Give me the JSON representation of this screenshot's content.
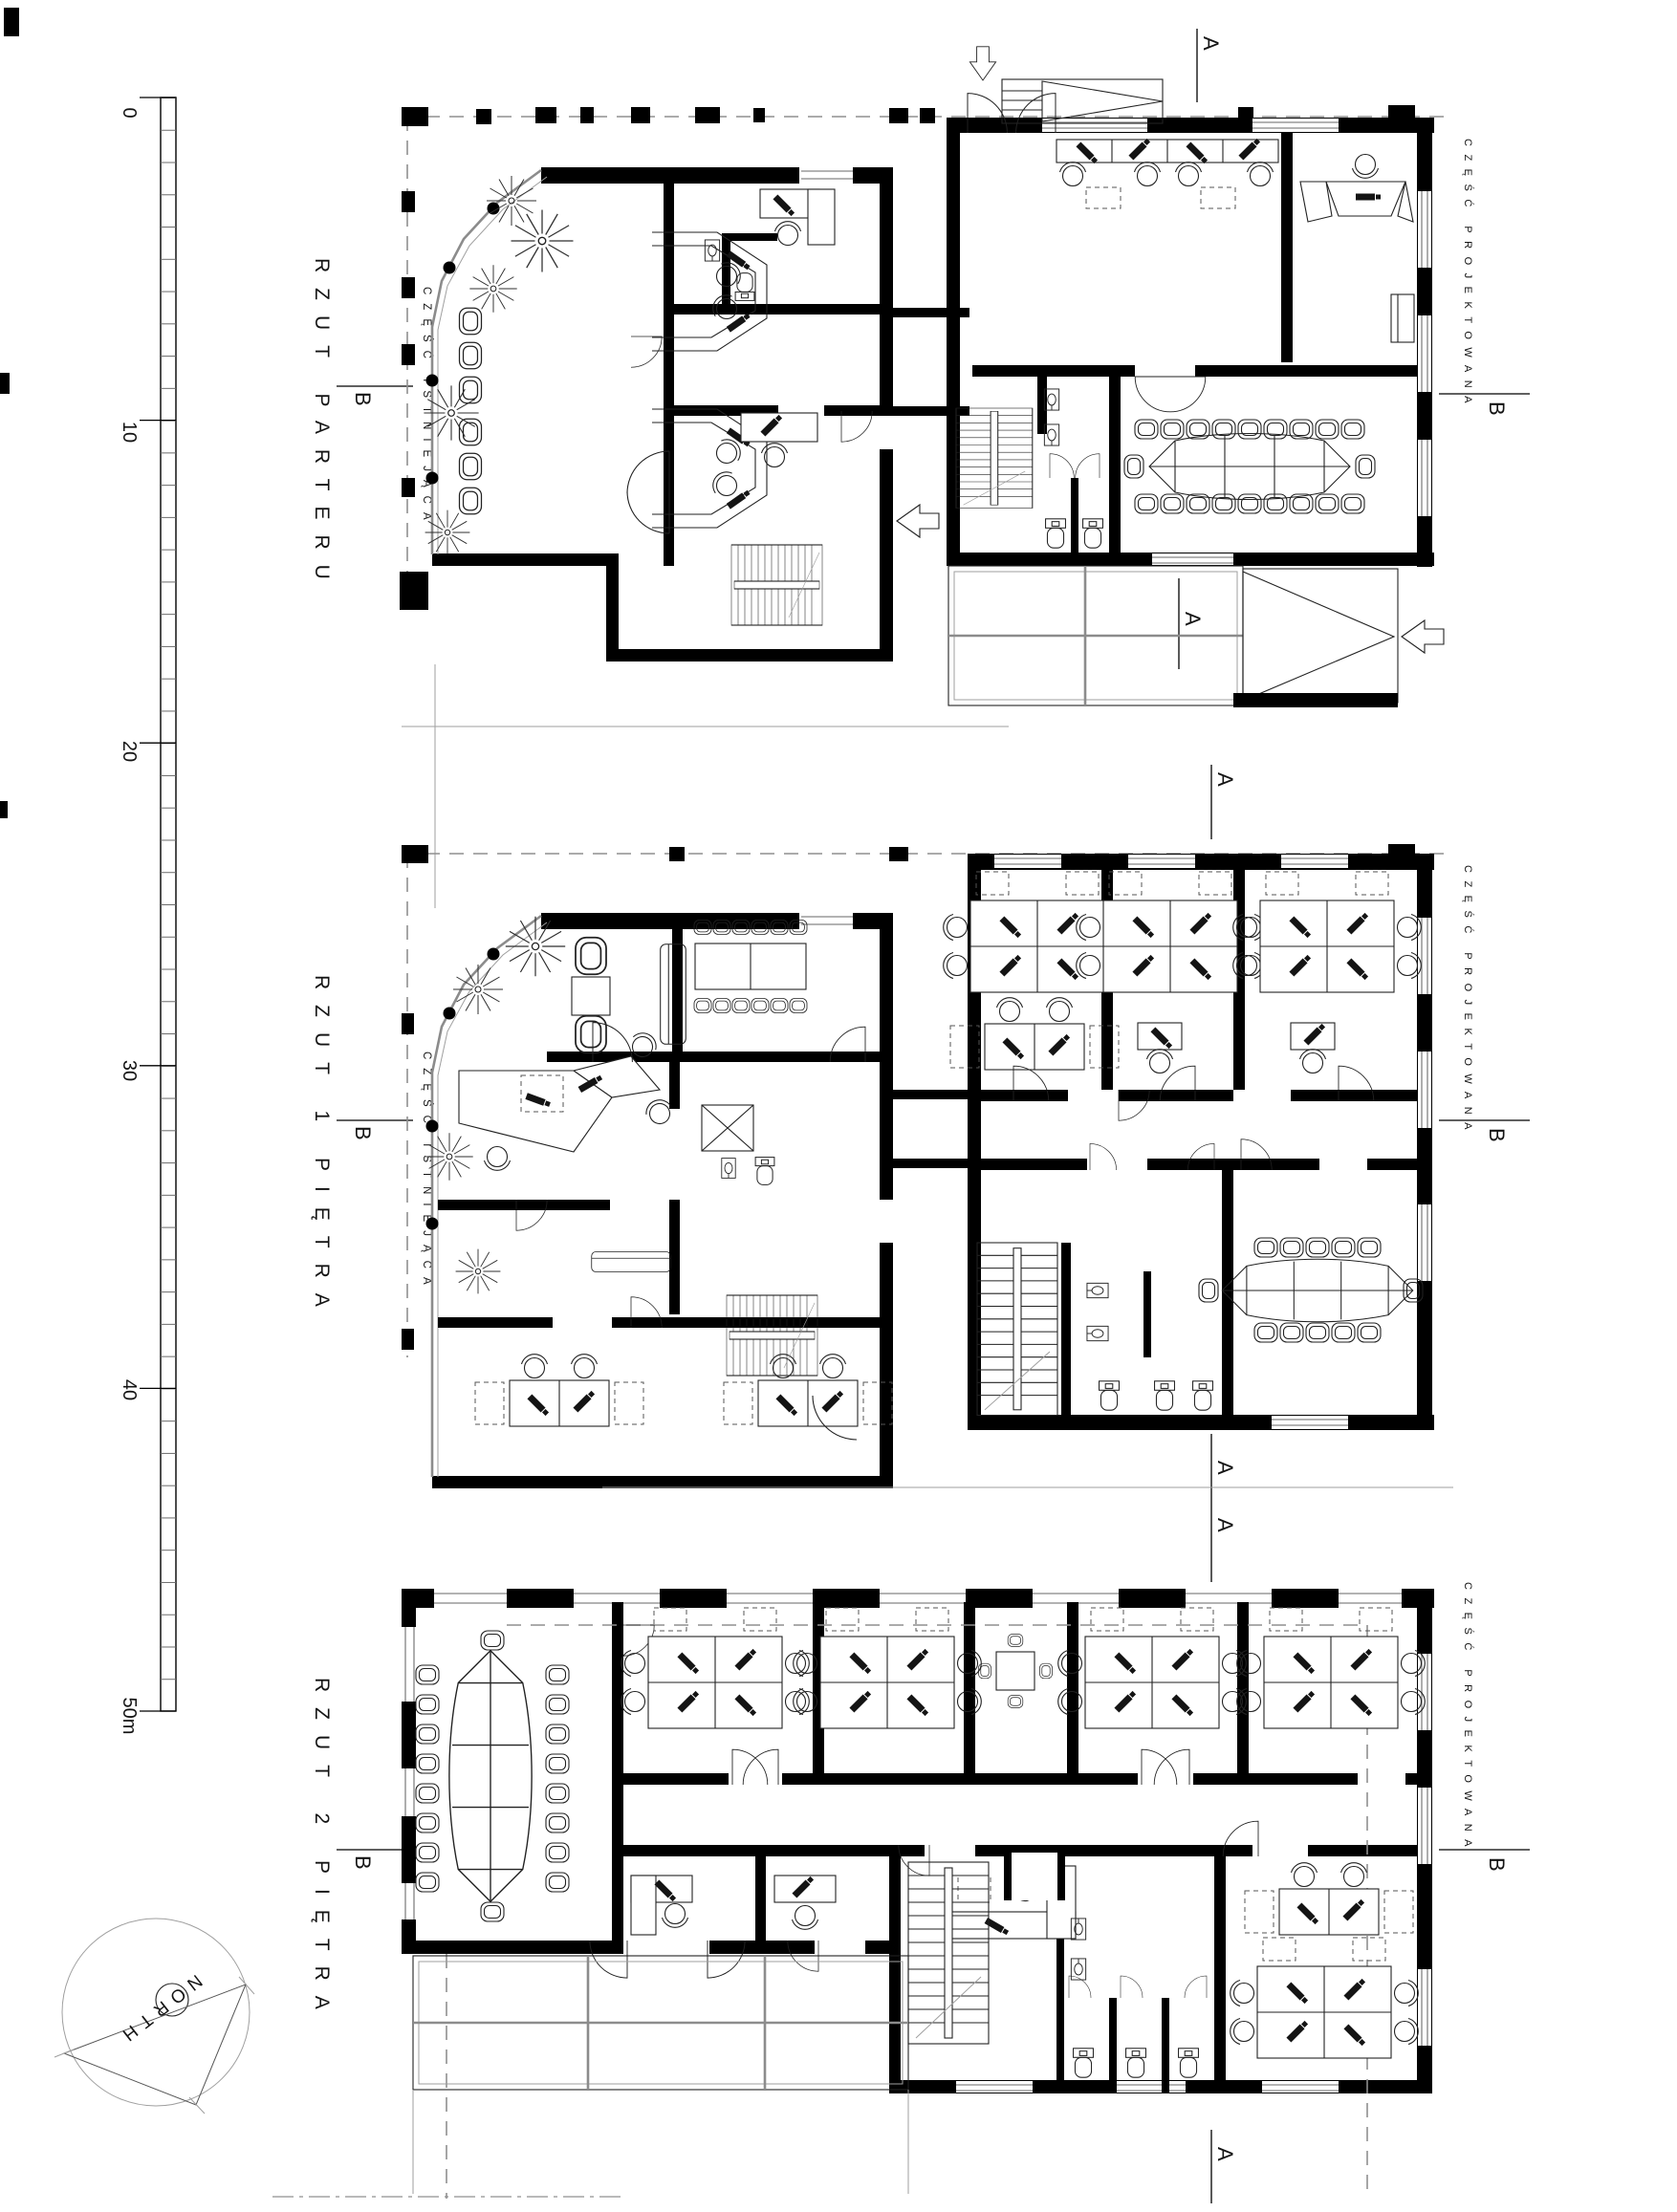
{
  "colors": {
    "ink": "#000000",
    "furniture": "#222222",
    "window_gray": "#9a9a9a",
    "dashed_gray": "#8f8f8f",
    "background": "#ffffff"
  },
  "scale_bar": {
    "tick_labels": [
      "0",
      "10",
      "20",
      "30",
      "40",
      "50m"
    ]
  },
  "compass": {
    "label": "NORTH"
  },
  "section_markers": {
    "a": "A",
    "b": "B"
  },
  "plans": [
    {
      "title": "RZUT PARTERU",
      "existing_label": "CZĘŚĆ ISTNIEJĄCA",
      "projected_label": "CZĘŚĆ PROJEKTOWANA"
    },
    {
      "title": "RZUT 1 PIĘTRA",
      "existing_label": "CZĘŚĆ ISTNIEJĄCA",
      "projected_label": "CZĘŚĆ PROJEKTOWANA"
    },
    {
      "title": "RZUT 2 PIĘTRA",
      "projected_label": "CZĘŚĆ PROJEKTOWANA"
    }
  ]
}
